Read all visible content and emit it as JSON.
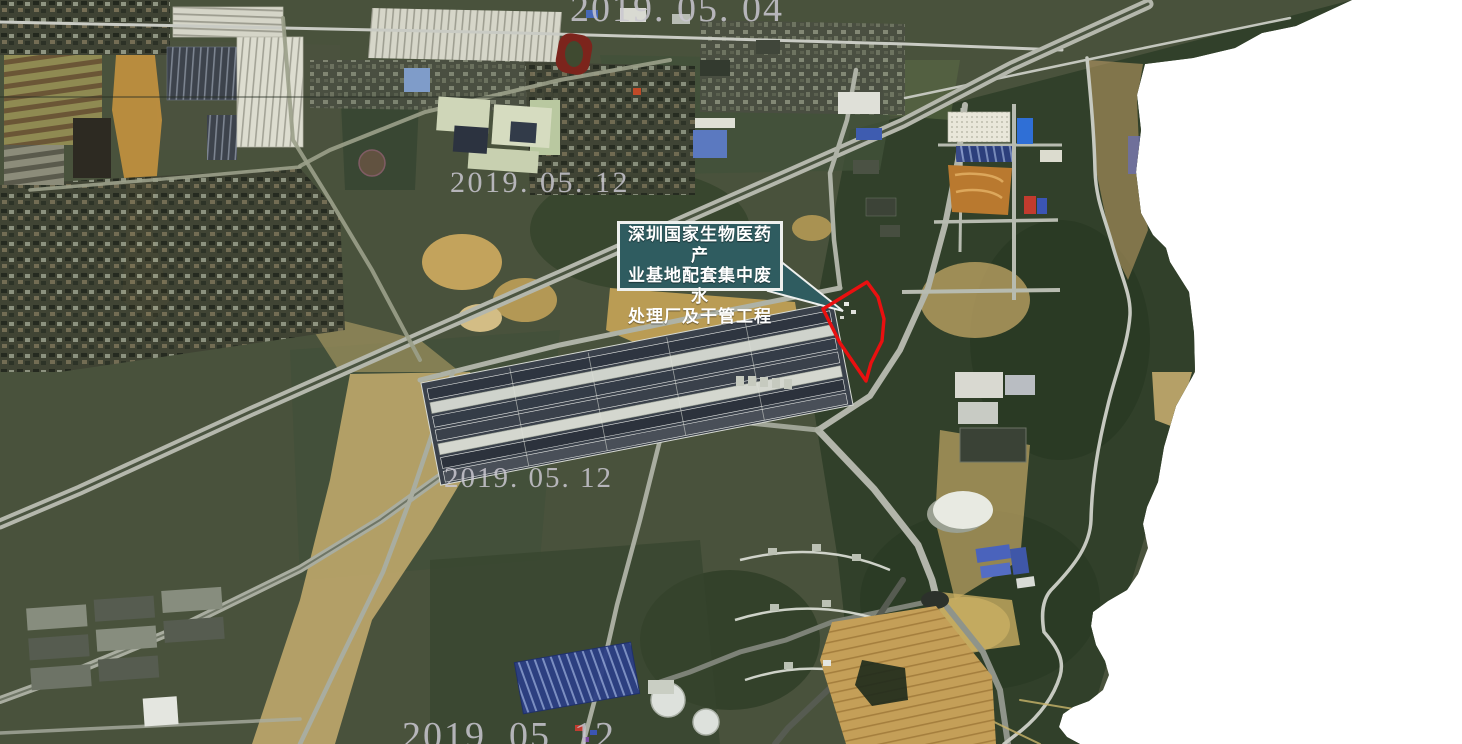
{
  "canvas": {
    "width": 1462,
    "height": 744,
    "background": "#ffffff"
  },
  "callout": {
    "lines": [
      "深圳国家生物医药产",
      "业基地配套集中废水",
      "处理厂及干管工程"
    ],
    "fill": "#2f5c60",
    "border_color": "#eef0ee",
    "text_color": "#ffffff",
    "pointer_points": "779,260 768,291 843,311"
  },
  "site_outline": {
    "color": "#ea1010",
    "points": "867,282 878,297 884,319 882,341 871,363 866,381 840,343 823,309"
  },
  "watermarks": [
    {
      "text": "2019. 05. 04"
    },
    {
      "text": "2019. 05. 12"
    },
    {
      "text": "2019. 05. 12"
    },
    {
      "text": "2019. 05. 12"
    }
  ],
  "map": {
    "type": "satellite-imagery",
    "land_color": "#49523c",
    "forest_color": "#31402a",
    "dirt_color": "#c2a058",
    "road_color": "#b4b7ac",
    "boundary_points": "0,0 1352,0 1296,26 1262,33 1235,48 1193,58 1145,64 1137,95 1141,130 1136,172 1141,213 1153,235 1166,248 1170,262 1189,292 1194,333 1195,372 1176,406 1164,447 1158,482 1147,507 1143,524 1148,548 1138,574 1127,590 1108,601 1093,612 1091,626 1096,645 1105,661 1109,675 1103,690 1089,701 1073,707 1063,714 1059,727 1067,737 1080,744 0,744"
  }
}
